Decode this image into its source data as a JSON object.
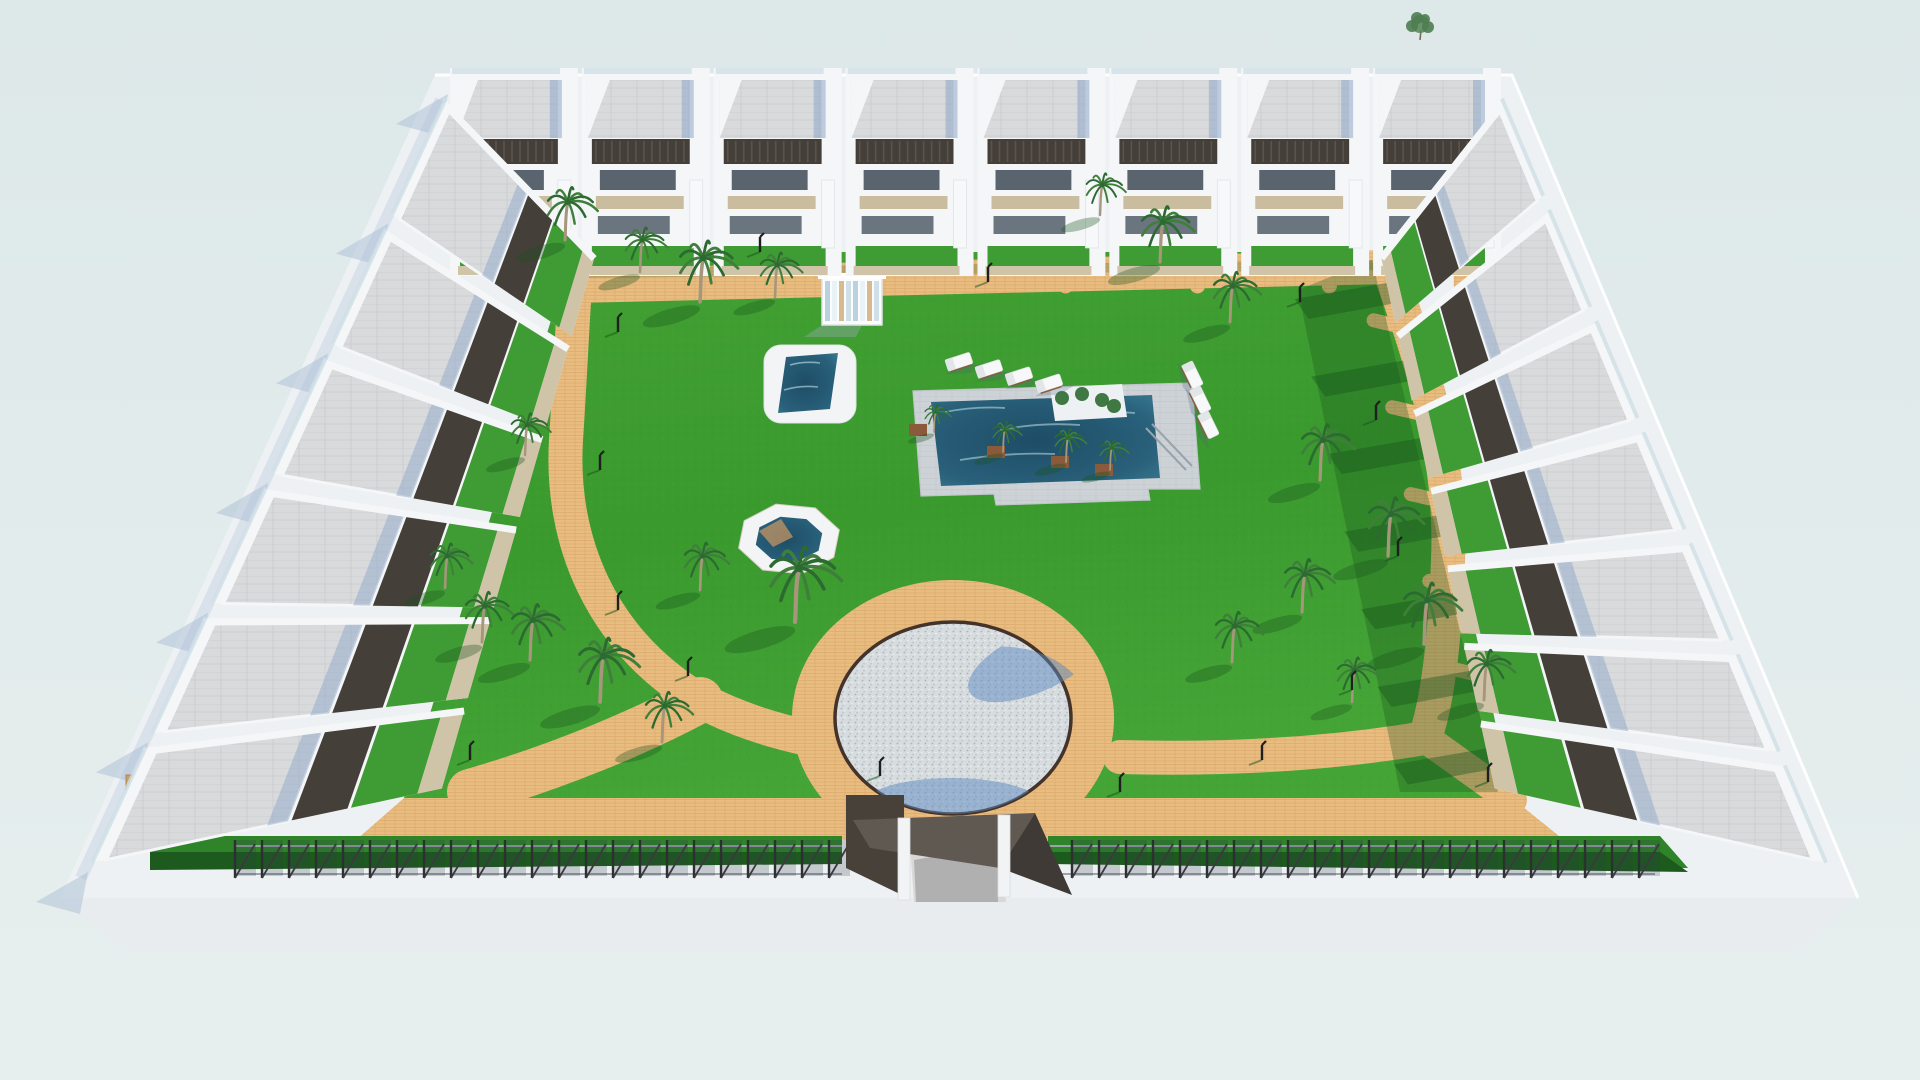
{
  "scene": {
    "kind": "3d-architectural-render",
    "description": "Aerial 3D render of a gated residential complex: white two-storey townhouses around a landscaped courtyard with a main pool, plunge pool, octagonal spa, pebble circle plaza, sandy paths, palm trees and an entrance gate",
    "counts": {
      "top_row_units": 8,
      "left_column_units": 6,
      "right_column_units": 7,
      "palm_trees": 26,
      "sun_loungers": 7,
      "path_lamps": 15
    },
    "palette": {
      "sky": "#dfe9e9",
      "sky_bottom": "#e7efee",
      "platform": "#eef1f3",
      "platform_front": "#e8ecee",
      "platform_edge": "#ffffff",
      "building": "#f4f6f8",
      "building_shade": "#dde3e8",
      "roof": "#d8dadc",
      "roof_line": "#c7c9cc",
      "roof_shade": "#8fa8c8",
      "pergola": "#453f39",
      "pergola_light": "#5a544c",
      "glass": "#cfe0e6",
      "window": "#3e4a57",
      "terrace_tan": "#cabd9f",
      "beige_wall": "#cfc3a8",
      "lawn_light": "#4aa438",
      "lawn": "#3a9a2e",
      "lawn_dark": "#2e8627",
      "garden": "#3f9b33",
      "shade_green": "#17531c",
      "sand": "#e9bc80",
      "sand_dark": "#cf9a62",
      "water_edge": "#3a7991",
      "water_deep": "#1e4d66",
      "water_sparkle": "#bfe2ea",
      "deck": "#ccd2d6",
      "deck_line": "#bfc6ca",
      "pebble": "#d7dcdf",
      "pebble_dot": "#a8b0b6",
      "pebble_rim": "#43332a",
      "hedge": "#2f8329",
      "hedge_dark": "#1d5a1d",
      "fence": "#2e2f33",
      "rail": "#9aa2aa",
      "shadow_blue": "#a9bdd6",
      "pool_shadow_blue": "#5b87c0",
      "trunk": "#a5967c",
      "frond": "#3f7f3b",
      "frond_dark": "#2c6a31",
      "planter": "#8a5a3a",
      "gate_dark": "#474139",
      "gate_mid": "#5f5952",
      "drive": "#d8d8d6",
      "lamp": "#1f1f22",
      "stray_leaf": "#5d8a5d"
    }
  },
  "objects": {
    "buildings": {
      "top": {
        "n": 8,
        "x0": 450,
        "x1": 1505
      },
      "left": {
        "n": 6,
        "outer": [
          [
            448,
            94
          ],
          [
            88,
            872
          ]
        ],
        "inner": [
          [
            596,
            252
          ],
          [
            440,
            795
          ]
        ]
      },
      "right": {
        "n": 7,
        "outer": [
          [
            1500,
            94
          ],
          [
            1830,
            872
          ]
        ],
        "inner": [
          [
            1380,
            252
          ],
          [
            1496,
            795
          ]
        ]
      }
    },
    "palms": [
      [
        565,
        240,
        0.95
      ],
      [
        640,
        272,
        0.8
      ],
      [
        700,
        302,
        1.1
      ],
      [
        775,
        297,
        0.8
      ],
      [
        525,
        455,
        0.75
      ],
      [
        795,
        622,
        1.35
      ],
      [
        700,
        590,
        0.85
      ],
      [
        530,
        660,
        1.0
      ],
      [
        600,
        702,
        1.15
      ],
      [
        662,
        742,
        0.9
      ],
      [
        445,
        588,
        0.8
      ],
      [
        482,
        642,
        0.9
      ],
      [
        1160,
        262,
        1.0
      ],
      [
        1230,
        322,
        0.9
      ],
      [
        1100,
        215,
        0.75
      ],
      [
        1320,
        480,
        1.0
      ],
      [
        1388,
        556,
        1.05
      ],
      [
        1302,
        612,
        0.95
      ],
      [
        1424,
        644,
        1.1
      ],
      [
        1232,
        662,
        0.9
      ],
      [
        1484,
        700,
        0.9
      ],
      [
        1352,
        702,
        0.8
      ]
    ],
    "pool_palms": [
      [
        1003,
        452,
        0.55
      ],
      [
        1066,
        462,
        0.6
      ],
      [
        1110,
        470,
        0.55
      ],
      [
        934,
        432,
        0.5
      ]
    ],
    "lamps": [
      [
        618,
        332
      ],
      [
        600,
        470
      ],
      [
        618,
        610
      ],
      [
        688,
        676
      ],
      [
        880,
        776
      ],
      [
        1120,
        792
      ],
      [
        1262,
        760
      ],
      [
        1352,
        690
      ],
      [
        1398,
        556
      ],
      [
        1376,
        420
      ],
      [
        1300,
        302
      ],
      [
        988,
        282
      ],
      [
        760,
        252
      ],
      [
        470,
        760
      ],
      [
        1488,
        782
      ]
    ],
    "loungers_a": {
      "start": [
        958,
        362
      ],
      "dx": 30,
      "dy": 7.2,
      "n": 4,
      "rot": -18
    },
    "loungers_b": {
      "start": [
        1192,
        374
      ],
      "dx": 8,
      "dy": 25,
      "n": 3,
      "rot": 64
    },
    "fence": {
      "x_start": 235,
      "x_end": 1655,
      "gap": [
        842,
        1048
      ],
      "step": 27,
      "y": 840
    },
    "stray_tree": [
      1420,
      24
    ],
    "plaza": {
      "cx": 953,
      "cy": 718,
      "rx": 118,
      "ry": 96
    },
    "octagon": {
      "cx": 789,
      "cy": 539,
      "rx": 52,
      "ry": 36
    },
    "plunge_pool": {
      "x": 764,
      "y": 345,
      "w": 92,
      "h": 78
    },
    "main_pool": {
      "deck": [
        [
          913,
          391
        ],
        [
          1192,
          383
        ],
        [
          1200,
          489
        ],
        [
          1148,
          489
        ],
        [
          1150,
          500
        ],
        [
          996,
          505
        ],
        [
          994,
          494
        ],
        [
          921,
          496
        ]
      ],
      "water": [
        [
          931,
          402
        ],
        [
          1152,
          395
        ],
        [
          1160,
          478
        ],
        [
          941,
          486
        ]
      ]
    },
    "pergola_cabana": {
      "x": 822,
      "y": 277,
      "w": 60,
      "h": 48
    },
    "gate": {
      "canopy": [
        [
          853,
          820
        ],
        [
          1035,
          813
        ],
        [
          1000,
          868
        ],
        [
          870,
          848
        ]
      ],
      "wing": [
        [
          1035,
          813
        ],
        [
          1072,
          895
        ],
        [
          1000,
          868
        ]
      ],
      "pillars": [
        [
          898,
          818
        ],
        [
          998,
          815
        ]
      ]
    }
  }
}
